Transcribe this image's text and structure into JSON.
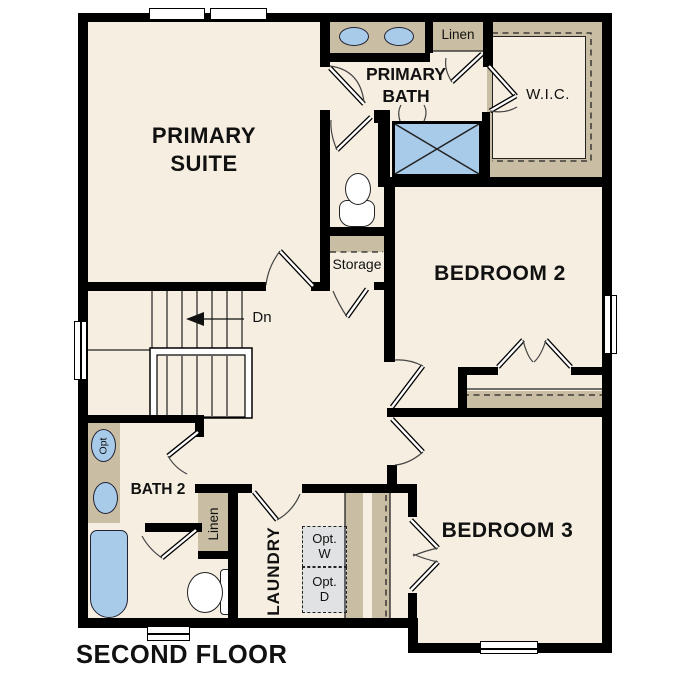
{
  "floor_label": "SECOND FLOOR",
  "colors": {
    "wall": "#000000",
    "floor": "#f5eee1",
    "casework": "#c9bda3",
    "fixture": "#a9cbea",
    "appliance": "#e0e2e3",
    "line": "#333333",
    "text": "#111111",
    "background": "#ffffff"
  },
  "labels": {
    "primary_suite": "PRIMARY SUITE",
    "primary_bath": "PRIMARY BATH",
    "wic": "W.I.C.",
    "linen_upper": "Linen",
    "bedroom_2": "BEDROOM 2",
    "storage": "Storage",
    "stairs_down": "Dn",
    "bath_2": "BATH 2",
    "linen_lower": "Linen",
    "laundry": "LAUNDRY",
    "opt_washer": "Opt. W",
    "opt_dryer": "Opt. D",
    "opt_shower": "Opt",
    "bedroom_3": "BEDROOM 3"
  }
}
